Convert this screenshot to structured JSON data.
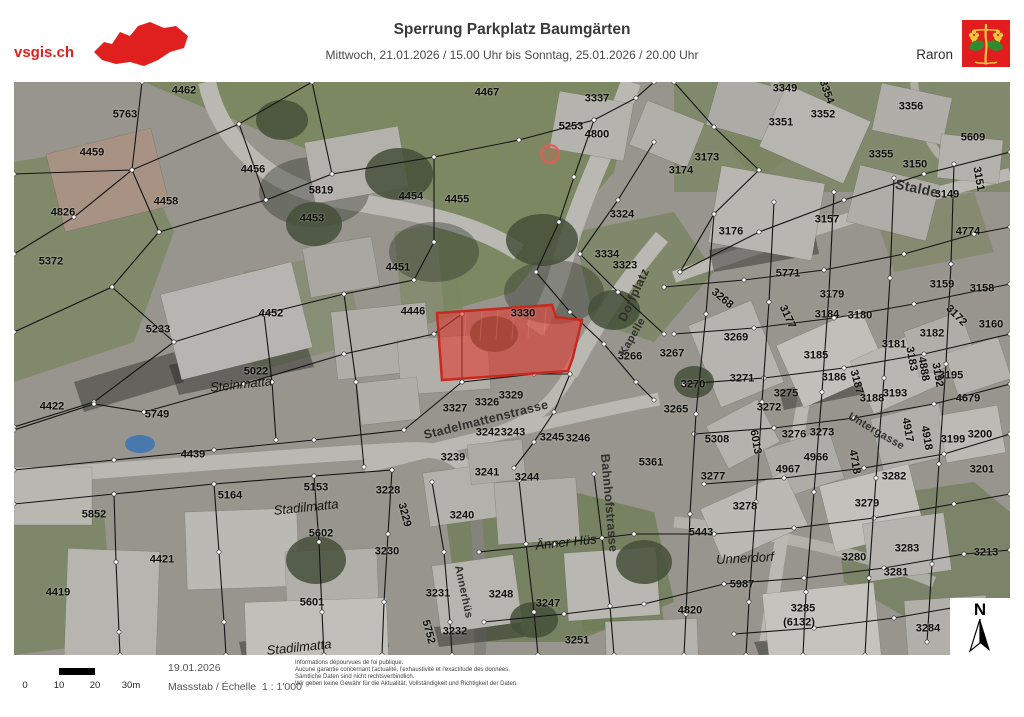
{
  "header": {
    "logo_text": "vsgis.ch",
    "title": "Sperrung Parkplatz Baumgärten",
    "subtitle": "Mittwoch, 21.01.2026 / 15.00 Uhr bis Sonntag, 25.01.2026 / 20.00 Uhr",
    "municipality": "Raron"
  },
  "compass": {
    "label": "N"
  },
  "footer": {
    "date": "19.01.2026",
    "scale_label": "Massstab / Échelle",
    "scale_value": "1 : 1'000",
    "scalebar_ticks": [
      "0",
      "10",
      "20",
      "30m"
    ],
    "disclaimer": [
      "Informations dépourvues de foi publique.",
      "Aucune garantie concernant l'actualité, l'exhaustivité et l'exactitude des données.",
      "Sämtliche Daten sind nicht rechtsverbindlich.",
      "Wir geben keine Gewähr für die Aktualität, Vollständigkeit und Richtigkeit der Daten."
    ]
  },
  "colors": {
    "accent_red": "#e01f1f",
    "shield_red": "#e31d1d"
  },
  "map": {
    "highlight_parcel": "3330",
    "highlight_fill": "#e03b30",
    "labels": [
      {
        "t": "4462",
        "x": 170,
        "y": 9
      },
      {
        "t": "5763",
        "x": 111,
        "y": 33
      },
      {
        "t": "4459",
        "x": 78,
        "y": 71
      },
      {
        "t": "4456",
        "x": 239,
        "y": 88
      },
      {
        "t": "5819",
        "x": 307,
        "y": 109
      },
      {
        "t": "4458",
        "x": 152,
        "y": 120
      },
      {
        "t": "4826",
        "x": 49,
        "y": 131
      },
      {
        "t": "4453",
        "x": 298,
        "y": 137
      },
      {
        "t": "5372",
        "x": 37,
        "y": 180
      },
      {
        "t": "4467",
        "x": 473,
        "y": 11
      },
      {
        "t": "3337",
        "x": 583,
        "y": 17
      },
      {
        "t": "5253",
        "x": 557,
        "y": 45
      },
      {
        "t": "4800",
        "x": 583,
        "y": 53
      },
      {
        "t": "4454",
        "x": 397,
        "y": 115
      },
      {
        "t": "4455",
        "x": 443,
        "y": 118
      },
      {
        "t": "3324",
        "x": 608,
        "y": 133
      },
      {
        "t": "3334",
        "x": 593,
        "y": 173
      },
      {
        "t": "3323",
        "x": 611,
        "y": 184
      },
      {
        "t": "4451",
        "x": 384,
        "y": 186
      },
      {
        "t": "4446",
        "x": 399,
        "y": 230
      },
      {
        "t": "3349",
        "x": 771,
        "y": 7
      },
      {
        "t": "3354",
        "x": 812,
        "y": 10,
        "r": 70
      },
      {
        "t": "3352",
        "x": 809,
        "y": 33
      },
      {
        "t": "3356",
        "x": 897,
        "y": 25
      },
      {
        "t": "3351",
        "x": 767,
        "y": 41
      },
      {
        "t": "5609",
        "x": 959,
        "y": 56
      },
      {
        "t": "3355",
        "x": 867,
        "y": 73
      },
      {
        "t": "3150",
        "x": 901,
        "y": 83
      },
      {
        "t": "3173",
        "x": 693,
        "y": 76
      },
      {
        "t": "3174",
        "x": 667,
        "y": 89
      },
      {
        "t": "3149",
        "x": 933,
        "y": 113
      },
      {
        "t": "3151",
        "x": 964,
        "y": 97,
        "r": 80
      },
      {
        "t": "3157",
        "x": 813,
        "y": 138
      },
      {
        "t": "3176",
        "x": 717,
        "y": 150
      },
      {
        "t": "4774",
        "x": 954,
        "y": 150
      },
      {
        "t": "5771",
        "x": 774,
        "y": 192
      },
      {
        "t": "3330",
        "x": 509,
        "y": 232
      },
      {
        "t": "3268",
        "x": 708,
        "y": 217,
        "r": 40
      },
      {
        "t": "3179",
        "x": 818,
        "y": 213
      },
      {
        "t": "3159",
        "x": 928,
        "y": 203
      },
      {
        "t": "3158",
        "x": 968,
        "y": 207
      },
      {
        "t": "3177",
        "x": 773,
        "y": 235,
        "r": 65
      },
      {
        "t": "3184",
        "x": 813,
        "y": 233
      },
      {
        "t": "3180",
        "x": 846,
        "y": 234
      },
      {
        "t": "3172",
        "x": 942,
        "y": 234,
        "r": 45
      },
      {
        "t": "3160",
        "x": 977,
        "y": 243
      },
      {
        "t": "3269",
        "x": 722,
        "y": 256
      },
      {
        "t": "3182",
        "x": 918,
        "y": 252
      },
      {
        "t": "3181",
        "x": 880,
        "y": 263
      },
      {
        "t": "3185",
        "x": 802,
        "y": 274
      },
      {
        "t": "3183",
        "x": 897,
        "y": 277,
        "r": 80
      },
      {
        "t": "4888",
        "x": 909,
        "y": 287,
        "r": 80
      },
      {
        "t": "3192",
        "x": 923,
        "y": 293,
        "r": 80
      },
      {
        "t": "3195",
        "x": 937,
        "y": 294
      },
      {
        "t": "3186",
        "x": 820,
        "y": 296
      },
      {
        "t": "3187",
        "x": 842,
        "y": 300,
        "r": 75
      },
      {
        "t": "3188",
        "x": 858,
        "y": 317
      },
      {
        "t": "3193",
        "x": 881,
        "y": 312
      },
      {
        "t": "4679",
        "x": 954,
        "y": 317
      },
      {
        "t": "3266",
        "x": 616,
        "y": 275
      },
      {
        "t": "3267",
        "x": 658,
        "y": 272
      },
      {
        "t": "3270",
        "x": 679,
        "y": 303
      },
      {
        "t": "3271",
        "x": 728,
        "y": 297
      },
      {
        "t": "3265",
        "x": 662,
        "y": 328
      },
      {
        "t": "3272",
        "x": 755,
        "y": 326
      },
      {
        "t": "3275",
        "x": 772,
        "y": 312
      },
      {
        "t": "5308",
        "x": 703,
        "y": 358
      },
      {
        "t": "6013",
        "x": 741,
        "y": 360,
        "r": 80
      },
      {
        "t": "3276",
        "x": 780,
        "y": 353
      },
      {
        "t": "3273",
        "x": 808,
        "y": 351
      },
      {
        "t": "4917",
        "x": 893,
        "y": 348,
        "r": 80
      },
      {
        "t": "4918",
        "x": 912,
        "y": 356,
        "r": 80
      },
      {
        "t": "3199",
        "x": 939,
        "y": 358
      },
      {
        "t": "3200",
        "x": 966,
        "y": 353
      },
      {
        "t": "3201",
        "x": 968,
        "y": 388
      },
      {
        "t": "4966",
        "x": 802,
        "y": 376
      },
      {
        "t": "4718",
        "x": 840,
        "y": 380,
        "r": 80
      },
      {
        "t": "3282",
        "x": 880,
        "y": 395
      },
      {
        "t": "3277",
        "x": 699,
        "y": 395
      },
      {
        "t": "4967",
        "x": 774,
        "y": 388
      },
      {
        "t": "3279",
        "x": 853,
        "y": 422
      },
      {
        "t": "3278",
        "x": 731,
        "y": 425
      },
      {
        "t": "5443",
        "x": 687,
        "y": 451
      },
      {
        "t": "3283",
        "x": 893,
        "y": 467
      },
      {
        "t": "3213",
        "x": 972,
        "y": 471
      },
      {
        "t": "3280",
        "x": 840,
        "y": 476
      },
      {
        "t": "3281",
        "x": 882,
        "y": 491
      },
      {
        "t": "5987",
        "x": 728,
        "y": 503
      },
      {
        "t": "4820",
        "x": 676,
        "y": 529
      },
      {
        "t": "3285",
        "x": 789,
        "y": 527
      },
      {
        "t": "(6132)",
        "x": 785,
        "y": 541
      },
      {
        "t": "3284",
        "x": 914,
        "y": 547
      },
      {
        "t": "5233",
        "x": 144,
        "y": 248
      },
      {
        "t": "4452",
        "x": 257,
        "y": 232
      },
      {
        "t": "5022",
        "x": 242,
        "y": 290
      },
      {
        "t": "5749",
        "x": 143,
        "y": 333
      },
      {
        "t": "4439",
        "x": 179,
        "y": 373
      },
      {
        "t": "4422",
        "x": 38,
        "y": 325
      },
      {
        "t": "5852",
        "x": 80,
        "y": 433
      },
      {
        "t": "5164",
        "x": 216,
        "y": 414
      },
      {
        "t": "5153",
        "x": 302,
        "y": 406
      },
      {
        "t": "5602",
        "x": 307,
        "y": 452
      },
      {
        "t": "4421",
        "x": 148,
        "y": 478
      },
      {
        "t": "4419",
        "x": 44,
        "y": 511
      },
      {
        "t": "5601",
        "x": 298,
        "y": 521
      },
      {
        "t": "3239",
        "x": 439,
        "y": 376
      },
      {
        "t": "3241",
        "x": 473,
        "y": 391
      },
      {
        "t": "3244",
        "x": 513,
        "y": 396
      },
      {
        "t": "5361",
        "x": 637,
        "y": 381
      },
      {
        "t": "3228",
        "x": 374,
        "y": 409
      },
      {
        "t": "3229",
        "x": 390,
        "y": 433,
        "r": 75
      },
      {
        "t": "3240",
        "x": 448,
        "y": 434
      },
      {
        "t": "3230",
        "x": 373,
        "y": 470
      },
      {
        "t": "3231",
        "x": 424,
        "y": 512
      },
      {
        "t": "3248",
        "x": 487,
        "y": 513
      },
      {
        "t": "3247",
        "x": 534,
        "y": 522
      },
      {
        "t": "5752",
        "x": 414,
        "y": 550,
        "r": 75
      },
      {
        "t": "3232",
        "x": 441,
        "y": 550
      },
      {
        "t": "3251",
        "x": 563,
        "y": 559
      },
      {
        "t": "3329",
        "x": 497,
        "y": 314
      },
      {
        "t": "3326",
        "x": 473,
        "y": 321
      },
      {
        "t": "3327",
        "x": 441,
        "y": 327
      },
      {
        "t": "3242",
        "x": 474,
        "y": 351
      },
      {
        "t": "3243",
        "x": 499,
        "y": 351
      },
      {
        "t": "3245",
        "x": 538,
        "y": 356
      },
      {
        "t": "3246",
        "x": 564,
        "y": 357
      },
      {
        "t": "Dorfplatz",
        "x": 620,
        "y": 213,
        "r": -65,
        "c": "h"
      },
      {
        "t": "Kapelle",
        "x": 619,
        "y": 255,
        "r": -60,
        "c": "h",
        "s": 11
      },
      {
        "t": "Stalde",
        "x": 903,
        "y": 106,
        "r": 12,
        "c": "h",
        "s": 14
      },
      {
        "t": "Stadelmattenstrasse",
        "x": 472,
        "y": 338,
        "r": -14,
        "c": "h"
      },
      {
        "t": "Bahnhofstrasse",
        "x": 595,
        "y": 421,
        "r": 85,
        "c": "h"
      },
      {
        "t": "Annerhüs",
        "x": 449,
        "y": 510,
        "r": 78,
        "c": "h",
        "s": 11
      },
      {
        "t": "Untergasse",
        "x": 862,
        "y": 350,
        "r": 30,
        "c": "h",
        "s": 11
      },
      {
        "t": "Steinmatta",
        "x": 227,
        "y": 302,
        "r": -6,
        "c": "a"
      },
      {
        "t": "Stadilmatta",
        "x": 292,
        "y": 425,
        "r": -6,
        "c": "a"
      },
      {
        "t": "Stadilmatta",
        "x": 285,
        "y": 565,
        "r": -6,
        "c": "a"
      },
      {
        "t": "Änner Hüs",
        "x": 552,
        "y": 460,
        "r": -6,
        "c": "a"
      },
      {
        "t": "Unnerdorf",
        "x": 731,
        "y": 476,
        "r": -3,
        "c": "a"
      }
    ]
  }
}
